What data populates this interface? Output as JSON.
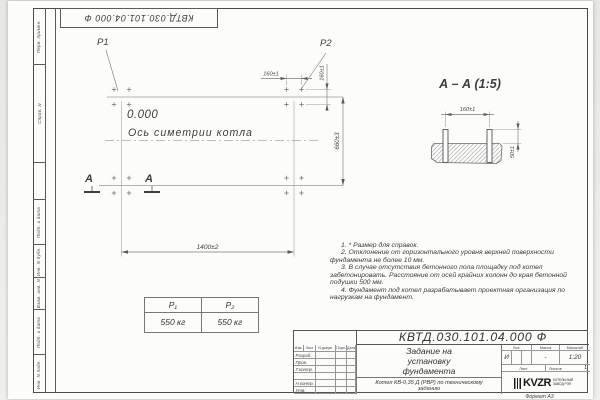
{
  "sheet": {
    "stamp_number": "КВТД.030.101.04.000  Ф",
    "format_label": "Формат А3",
    "margin_labels": [
      "Перв. примен.",
      "Справ. N",
      "",
      "Подп. и дата",
      "Инв. N дубл.",
      "Взам. инв. N",
      "Подп. и дата",
      "Инв. N подл."
    ]
  },
  "plan": {
    "p1_label": "P1",
    "p2_label": "P2",
    "level_label": "0.000",
    "axis_label": "Ось симетрии котла",
    "dim_width": "1400±2",
    "dim_height": "660±3",
    "dim_bolt_x": "160±1",
    "dim_bolt_y": "160±1",
    "section_letter": "А"
  },
  "section": {
    "title": "А – А (1:5)",
    "dim_spacing": "160±1",
    "dim_height": "50±1"
  },
  "notes": [
    "1. * Размер для справок.",
    "2. Отклонение от горизонтального уровня верхней поверхности фундамента не более 10 мм.",
    "3. В случае отсутствия бетонного пола площадку под котел забетонировать. Расстояние от осей крайних колонн до края бетонной подушки 500 мм.",
    "4. Фундамент под котел разрабатывает проектная организация по нагрузкам на фундамент."
  ],
  "load_table": {
    "headers": [
      "Р₁",
      "Р₂"
    ],
    "values": [
      "550 кг",
      "550 кг"
    ]
  },
  "title_block": {
    "doc_number": "КВТД.030.101.04.000  Ф",
    "title_lines": [
      "Задание на",
      "установку",
      "фундамента"
    ],
    "subject": "Котел КВ-0,35 Д (РВР) по техническому заданию",
    "change_header": [
      "Изм.",
      "Лист",
      "N докум.",
      "Подп.",
      "Дата"
    ],
    "rows": [
      "Разраб.",
      "Пров.",
      "Т.контр.",
      "",
      "Н.контр.",
      "Утв."
    ],
    "lit_header": "Лит.",
    "mass_header": "Масса",
    "scale_header": "Масштаб",
    "lit_value": "И",
    "mass_value": "-",
    "scale_value": "1:20",
    "sheet_label": "Лист",
    "sheets_label": "Листов",
    "sheets_value": "1",
    "logo_text": "KVZR",
    "logo_caption": "КОТЕЛЬНЫЙ ЗАВОД РЭП",
    "format_label": "Формат А3"
  },
  "colors": {
    "line": "#555555",
    "dim": "#7d7d7d",
    "text": "#3d3d3d",
    "frame": "#4a4a4a"
  }
}
